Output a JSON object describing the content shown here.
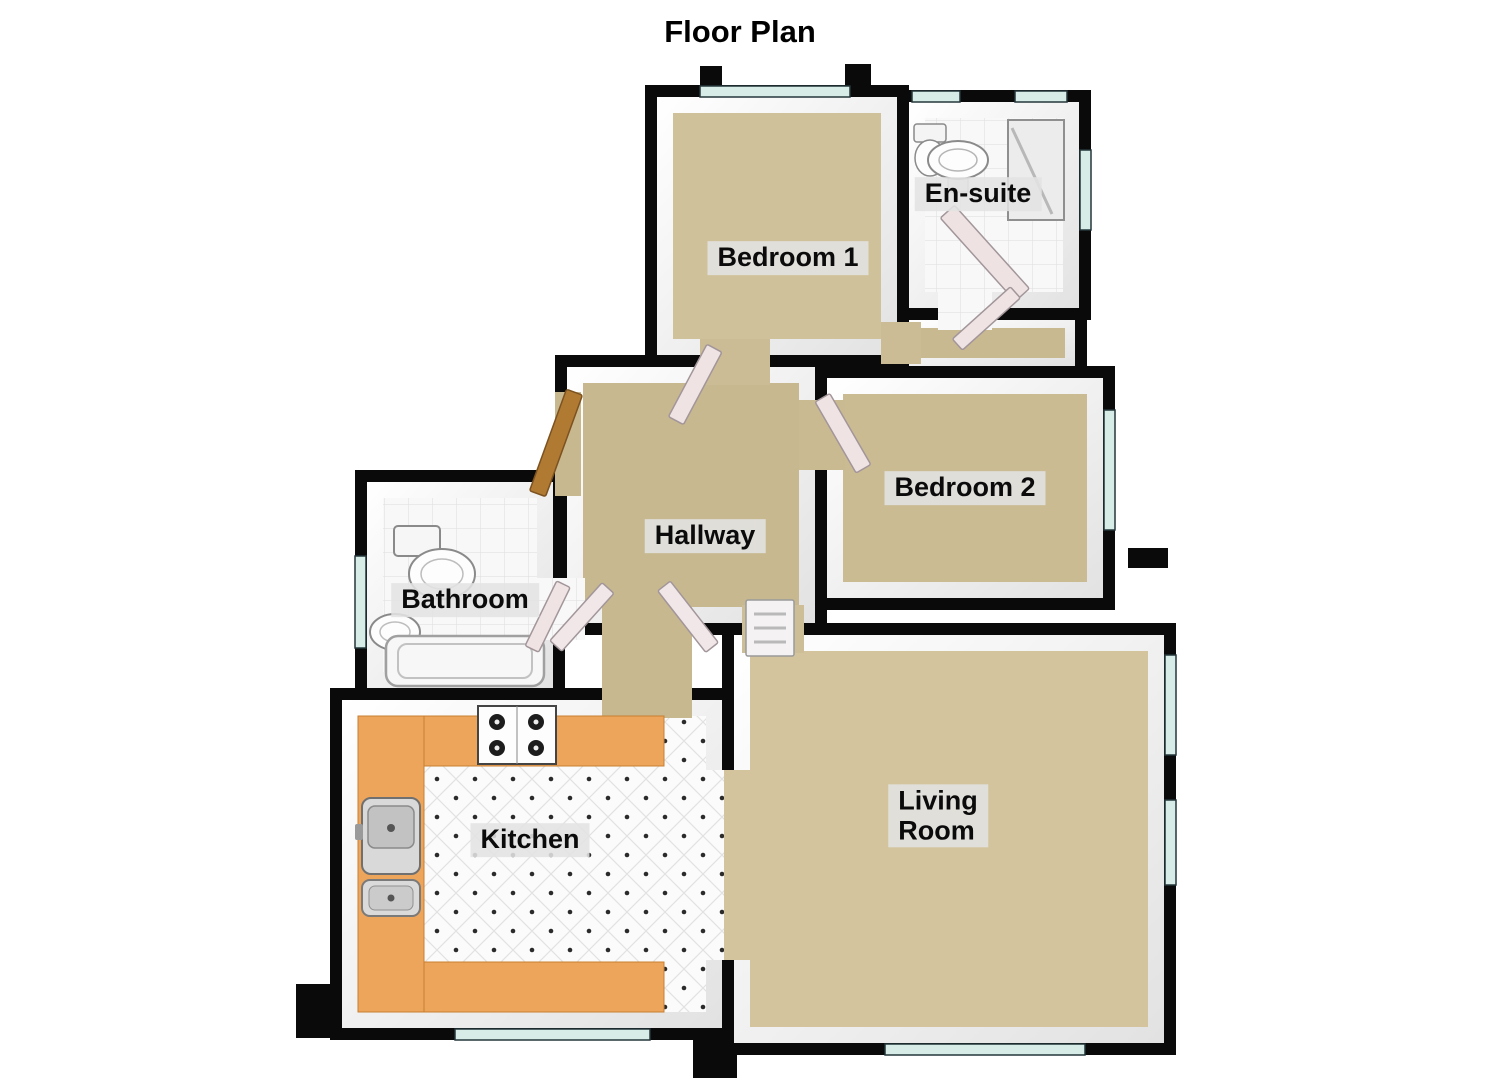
{
  "title": "Floor Plan",
  "rooms": [
    {
      "id": "bedroom1",
      "label": "Bedroom 1"
    },
    {
      "id": "ensuite",
      "label": "En-suite"
    },
    {
      "id": "bedroom2",
      "label": "Bedroom 2"
    },
    {
      "id": "hallway",
      "label": "Hallway"
    },
    {
      "id": "bathroom",
      "label": "Bathroom"
    },
    {
      "id": "kitchen",
      "label": "Kitchen"
    },
    {
      "id": "living",
      "label": "Living Room",
      "label_lines": [
        "Living",
        "Room"
      ]
    }
  ],
  "fixtures": {
    "ensuite": [
      "toilet",
      "sink",
      "shower"
    ],
    "bathroom": [
      "toilet",
      "sink",
      "bathtub"
    ],
    "kitchen": [
      "hob",
      "double-sink",
      "u-shaped-counter"
    ],
    "hallway": [
      "front-door",
      "interior-doors"
    ]
  },
  "colors": {
    "wall": "#0a0a0a",
    "wall_face": "#f2f2f2",
    "carpet": "#ccbd96",
    "tile": "#f8f8f8",
    "kitchen_counter": "#eda55c",
    "window_glass": "#d8ece7",
    "front_door": "#b07a33",
    "interior_door": "#efe3e4",
    "label_background": "#e3e3e3",
    "label_text": "#0b0b0b"
  }
}
